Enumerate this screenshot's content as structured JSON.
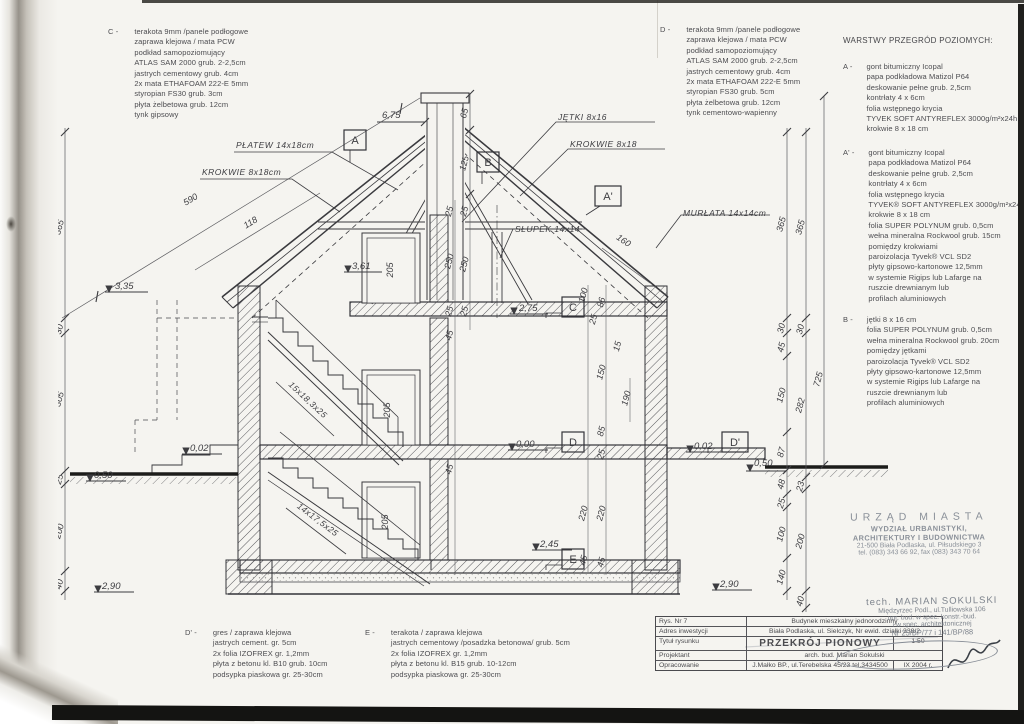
{
  "specs": {
    "c": {
      "label": "C -",
      "lines": [
        "terakota 9mm /panele podłogowe",
        "zaprawa klejowa / mata PCW",
        "podkład samopoziomujący",
        "ATLAS SAM 2000 grub. 2-2,5cm",
        "jastrych cementowy grub. 4cm",
        "2x mata ETHAFOAM 222-E 5mm",
        "styropian FS30 grub. 3cm",
        "płyta żelbetowa grub. 12cm",
        "tynk gipsowy"
      ]
    },
    "d": {
      "label": "D -",
      "lines": [
        "terakota 9mm /panele podłogowe",
        "zaprawa klejowa / mata PCW",
        "podkład samopoziomujący",
        "ATLAS SAM 2000 grub. 2-2,5cm",
        "jastrych cementowy grub. 4cm",
        "2x mata ETHAFOAM 222-E 5mm",
        "styropian FS30 grub. 5cm",
        "płyta żelbetowa grub. 12cm",
        "tynk cementowo-wapienny"
      ]
    },
    "d_prime": {
      "label": "D' -",
      "lines": [
        "gres / zaprawa klejowa",
        "jastrych cement. gr. 5cm",
        "2x folia IZOFREX gr. 1,2mm",
        "płyta z betonu kl. B10 grub. 10cm",
        "podsypka piaskowa gr. 25-30cm"
      ]
    },
    "e": {
      "label": "E -",
      "lines": [
        "terakota / zaprawa klejowa",
        "jastrych cementowy /posadzka betonowa/ grub. 5cm",
        "2x folia IZOFREX gr. 1,2mm",
        "płyta z betonu kl. B15 grub. 10-12cm",
        "podsypka piaskowa gr. 25-30cm"
      ]
    }
  },
  "layers": {
    "header": "WARSTWY PRZEGRÓD POZIOMYCH:",
    "a": {
      "label": "A -",
      "lines": [
        "gont bitumiczny Icopal",
        "papa podkładowa Matizol P64",
        "deskowanie pełne grub. 2,5cm",
        "kontrłaty 4 x 6cm",
        "folia wstępnego krycia",
        "TYVEK SOFT ANTYREFLEX 3000g/m²x24h",
        "krokwie 8 x 18 cm"
      ]
    },
    "a_prime": {
      "label": "A' -",
      "lines": [
        "gont bitumiczny Icopal",
        "papa podkładowa Matizol P64",
        "deskowanie pełne grub. 2,5cm",
        "kontrłaty 4 x 6cm",
        "folia wstępnego krycia",
        "TYVEK® SOFT ANTYREFLEX 3000g/m²x24h",
        "krokwie 8 x 18 cm",
        "folia SUPER POLYNUM grub. 0,5cm",
        "wełna mineralna Rockwool grub. 15cm",
        "pomiędzy krokwiami",
        "paroizolacja Tyvek® VCL SD2",
        "płyty gipsowo-kartonowe 12,5mm",
        "w systemie Rigips lub Lafarge na",
        "ruszcie drewnianym lub",
        "profilach aluminiowych"
      ]
    },
    "b": {
      "label": "B -",
      "lines": [
        "jętki 8 x 16 cm",
        "folia SUPER POLYNUM grub. 0,5cm",
        "wełna mineralna Rockwool grub. 20cm",
        "pomiędzy jętkami",
        "paroizolacja Tyvek® VCL SD2",
        "płyty gipsowo-kartonowe 12,5mm",
        "w systemie Rigips lub Lafarge na",
        "ruszcie drewnianym lub",
        "profilach aluminiowych"
      ]
    }
  },
  "drawing": {
    "labels": {
      "platew": "PŁATEW 14x18cm",
      "krokwie_left": "KROKWIE 8x18cm",
      "jetki": "JĘTKI 8x16",
      "krokwie_right": "KROKWIE 8x18",
      "murlata": "MURŁATA 14x14cm",
      "slupek": "SŁUPEK 14x14",
      "stairs_upper": "15x18,3x25",
      "stairs_lower": "14x17,5x25"
    },
    "levels": {
      "ridge": "6,75",
      "eaves_left": "3,35",
      "attic_left": "3,61",
      "c": "2,75",
      "zero": "0,00",
      "terrace_left": "0,02",
      "terrace_right": "0,02",
      "ground_left": "0,50",
      "ground_right": "0,50",
      "basement": "2,45",
      "foundation_left": "2,90",
      "foundation_right": "2,90"
    },
    "markers": {
      "a": "A",
      "b": "B",
      "a_prime": "A'",
      "c": "C",
      "d": "D",
      "d_prime": "D'",
      "e": "E"
    },
    "dims": {
      "left_outer": [
        "365",
        "30",
        "330",
        "240"
      ],
      "left_inner": [
        "365",
        "30",
        "305",
        "25",
        "200",
        "40"
      ],
      "right_inner": [
        "365",
        "30",
        "45",
        "150",
        "87",
        "48",
        "25",
        "100",
        "140"
      ],
      "right_outer": [
        "365",
        "30",
        "282",
        "23",
        "200",
        "40"
      ],
      "right_total": "725",
      "chimney": [
        "65",
        "125"
      ],
      "slope_left": "590",
      "slope_mid": "118",
      "slope_right": "160",
      "interior": [
        "25",
        "25",
        "250",
        "250",
        "25",
        "25",
        "45",
        "45",
        "205",
        "205",
        "205",
        "100",
        "86",
        "25",
        "15",
        "150",
        "85",
        "25",
        "190",
        "220",
        "220",
        "45",
        "45"
      ]
    }
  },
  "title_block": {
    "rows": [
      {
        "label": "Rys. Nr 7",
        "value": "Budynek mieszkalny jednorodzinny"
      },
      {
        "label": "Adres inwestycji",
        "value": "Biała Podlaska, ul. Sielczyk, Nr ewid. działki 338/2"
      },
      {
        "label": "Tytuł rysunku",
        "value": "PRZEKRÓJ PIONOWY",
        "extra": "1:50"
      },
      {
        "label": "Projektant",
        "value": "arch. bud. Marian Sokulski"
      },
      {
        "label": "Opracowanie",
        "value": "J.Małko BP., ul.Terebelska 45/23 tel.3434500",
        "extra": "IX 2004 r."
      }
    ]
  },
  "stamps": {
    "city": {
      "lines": [
        "URZĄD MIASTA",
        "WYDZIAŁ URBANISTYKI,",
        "ARCHITEKTURY I BUDOWNICTWA",
        "21-500 Biała Podlaska, ul. Piłsudskiego 3",
        "tel. (083) 343 66 92, fax (083) 343 70 64"
      ]
    },
    "person": {
      "lines": [
        "tech. MARIAN SOKULSKI",
        "Międzyrzec Podl., ul.Tulliowska 106",
        "upr. bud. w spec. konstr.-bud.",
        "i w spec. architektonicznej",
        "Nr 25/BP/77 i 141/BP/88"
      ]
    }
  }
}
